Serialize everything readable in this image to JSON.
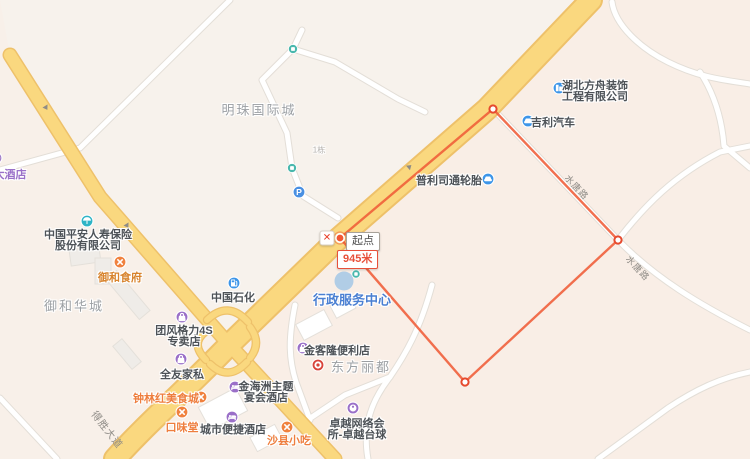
{
  "map": {
    "measurement": {
      "start_label": "起点",
      "distance_label": "945米",
      "close_glyph": "✕",
      "line_color": "#ef5c38",
      "vertices": [
        {
          "x": 340,
          "y": 238
        },
        {
          "x": 493,
          "y": 109
        },
        {
          "x": 618,
          "y": 240
        },
        {
          "x": 465,
          "y": 382
        }
      ],
      "closed": true,
      "start_marker": {
        "x": 340,
        "y": 238
      },
      "close_button": {
        "x": 327,
        "y": 238
      },
      "start_label_pos": {
        "x": 346,
        "y": 232
      },
      "distance_label_pos": {
        "x": 337,
        "y": 250
      }
    },
    "road_labels": [
      {
        "text": "水唐路",
        "x": 577,
        "y": 187,
        "rotation": 47,
        "size": 9
      },
      {
        "text": "水唐路",
        "x": 638,
        "y": 268,
        "rotation": 47,
        "size": 9
      },
      {
        "text": "得胜大道",
        "x": 108,
        "y": 429,
        "rotation": 52,
        "size": 10
      }
    ],
    "pois": [
      {
        "id": "hotel-partial",
        "icon": {
          "type": "bed",
          "color": "#a07cc8",
          "x": -4,
          "y": 158,
          "size": 13
        },
        "label": {
          "lines": [
            "大酒店"
          ],
          "x": 10,
          "y": 174,
          "color": "#9a70c8",
          "size": 11
        }
      },
      {
        "id": "mingzhu-international-area",
        "label": {
          "lines": [
            "明珠国际城"
          ],
          "x": 259,
          "y": 109,
          "color": "#9b9fa3",
          "size": 13,
          "ls": 2,
          "area": true
        }
      },
      {
        "id": "building-no1",
        "label": {
          "lines": [
            "1栋"
          ],
          "x": 319,
          "y": 150,
          "color": "#b3b0ac",
          "size": 8,
          "area": true
        }
      },
      {
        "id": "pingan-insurance",
        "icon": {
          "type": "umbrella",
          "color": "#2eb4c6",
          "x": 87,
          "y": 221,
          "size": 13
        },
        "label": {
          "lines": [
            "中国平安人寿保险",
            "股份有限公司"
          ],
          "x": 88,
          "y": 234,
          "color": "#4d5257",
          "size": 11
        }
      },
      {
        "id": "yuhe-restaurant",
        "icon": {
          "type": "food",
          "color": "#f0813e",
          "x": 120,
          "y": 262,
          "size": 13
        },
        "label": {
          "lines": [
            "御和食府"
          ],
          "x": 120,
          "y": 277,
          "color": "#d8842e",
          "size": 11
        }
      },
      {
        "id": "yuhe-huacheng-area",
        "label": {
          "lines": [
            "御和华城"
          ],
          "x": 74,
          "y": 305,
          "color": "#9b9fa3",
          "size": 13,
          "ls": 2,
          "area": true
        }
      },
      {
        "id": "sinopec",
        "icon": {
          "type": "fuel",
          "color": "#3d95e8",
          "x": 234,
          "y": 283,
          "size": 13
        },
        "label": {
          "lines": [
            "中国石化"
          ],
          "x": 233,
          "y": 297,
          "color": "#4d5257",
          "size": 11
        }
      },
      {
        "id": "admin-service-center",
        "label": {
          "lines": [
            "行政服务中心"
          ],
          "x": 352,
          "y": 299,
          "color": "#4a7fd2",
          "size": 13
        }
      },
      {
        "id": "bridgestone-tires",
        "icon": {
          "type": "car",
          "color": "#3d95e8",
          "x": 488,
          "y": 179,
          "size": 13
        },
        "label": {
          "lines": [
            "普利司通轮胎"
          ],
          "x": 449,
          "y": 180,
          "color": "#4d5257",
          "size": 11
        }
      },
      {
        "id": "fangzhou-decoration",
        "icon": {
          "type": "building",
          "color": "#3d95e8",
          "x": 559,
          "y": 88,
          "size": 13
        },
        "label": {
          "lines": [
            "湖北方舟装饰",
            "工程有限公司"
          ],
          "x": 595,
          "y": 85,
          "color": "#4d5257",
          "size": 11
        }
      },
      {
        "id": "geely-auto",
        "icon": {
          "type": "car",
          "color": "#3d95e8",
          "x": 528,
          "y": 121,
          "size": 13
        },
        "label": {
          "lines": [
            "吉利汽车"
          ],
          "x": 553,
          "y": 122,
          "color": "#4d5257",
          "size": 11
        }
      },
      {
        "id": "gree-4s-store",
        "icon": {
          "type": "bag",
          "color": "#9a6fc8",
          "x": 182,
          "y": 317,
          "size": 13
        },
        "label": {
          "lines": [
            "团风格力4S",
            "专卖店"
          ],
          "x": 184,
          "y": 330,
          "color": "#4d5257",
          "size": 11
        }
      },
      {
        "id": "quanyou-furniture",
        "icon": {
          "type": "bag",
          "color": "#9a6fc8",
          "x": 181,
          "y": 359,
          "size": 13
        },
        "label": {
          "lines": [
            "全友家私"
          ],
          "x": 182,
          "y": 374,
          "color": "#4d5257",
          "size": 11
        }
      },
      {
        "id": "zhonglinhong-food-city",
        "icon": {
          "type": "food",
          "color": "#f0813e",
          "x": 201,
          "y": 397,
          "size": 13
        },
        "label": {
          "lines": [
            "钟林红美食城"
          ],
          "x": 166,
          "y": 398,
          "color": "#ee7e3e",
          "size": 11
        }
      },
      {
        "id": "kouweitang",
        "icon": {
          "type": "food",
          "color": "#f0813e",
          "x": 182,
          "y": 412,
          "size": 13
        },
        "label": {
          "lines": [
            "口味堂"
          ],
          "x": 182,
          "y": 427,
          "color": "#ee7e3e",
          "size": 11
        }
      },
      {
        "id": "jinhaizhou-banquet-hotel",
        "icon": {
          "type": "bed",
          "color": "#9a6fc8",
          "x": 235,
          "y": 387,
          "size": 13
        },
        "label": {
          "lines": [
            "金海洲主题",
            "宴会酒店"
          ],
          "x": 266,
          "y": 386,
          "color": "#4d5257",
          "size": 11
        }
      },
      {
        "id": "city-comfort-inn",
        "icon": {
          "type": "bed",
          "color": "#9a6fc8",
          "x": 232,
          "y": 417,
          "size": 13
        },
        "label": {
          "lines": [
            "城市便捷酒店"
          ],
          "x": 233,
          "y": 429,
          "color": "#4d5257",
          "size": 11
        }
      },
      {
        "id": "shaxian-snacks",
        "icon": {
          "type": "food",
          "color": "#f0813e",
          "x": 287,
          "y": 427,
          "size": 13
        },
        "label": {
          "lines": [
            "沙县小吃"
          ],
          "x": 289,
          "y": 440,
          "color": "#ee7e3e",
          "size": 11
        }
      },
      {
        "id": "jinkelong-store",
        "icon": {
          "type": "bag",
          "color": "#9a6fc8",
          "x": 303,
          "y": 348,
          "size": 13
        },
        "label": {
          "lines": [
            "金客隆便利店"
          ],
          "x": 337,
          "y": 350,
          "color": "#4d5257",
          "size": 11
        }
      },
      {
        "id": "bank-poi",
        "icon": {
          "type": "bank",
          "color": "#d8433a",
          "x": 318,
          "y": 365,
          "size": 13
        }
      },
      {
        "id": "dongfang-lidu-area",
        "label": {
          "lines": [
            "东方丽都"
          ],
          "x": 361,
          "y": 366,
          "color": "#9b9fa3",
          "size": 13,
          "ls": 2,
          "area": true
        }
      },
      {
        "id": "zhuoyue-club-billiards",
        "icon": {
          "type": "billiard",
          "color": "#9a6fc8",
          "x": 353,
          "y": 408,
          "size": 13
        },
        "label": {
          "lines": [
            "卓越网络会",
            "所-卓越台球"
          ],
          "x": 357,
          "y": 423,
          "color": "#4d5257",
          "size": 11
        }
      },
      {
        "id": "parking",
        "icon": {
          "type": "parking",
          "color": "#4a90e2",
          "x": 299,
          "y": 192,
          "size": 13
        }
      },
      {
        "id": "mini-poi-north",
        "icon": {
          "type": "dot",
          "color": "#49b8ad",
          "x": 293,
          "y": 49,
          "size": 10
        }
      },
      {
        "id": "mini-poi-mid",
        "icon": {
          "type": "dot",
          "color": "#49b8ad",
          "x": 292,
          "y": 168,
          "size": 10
        }
      },
      {
        "id": "mini-poi-admin",
        "icon": {
          "type": "dot",
          "color": "#49b8ad",
          "x": 356,
          "y": 274,
          "size": 9
        }
      }
    ],
    "admin_marker": {
      "x": 344,
      "y": 281
    }
  },
  "colors": {
    "bg": "#f7f2ec",
    "tint_right": "#f9eee6",
    "tint_left": "#f8f0e9",
    "road_yellow": "#fad87f",
    "road_yellow_casing": "#eec16a",
    "road_white": "#ffffff",
    "road_white_casing": "#e3ded7",
    "measure": "#ef5c38"
  }
}
